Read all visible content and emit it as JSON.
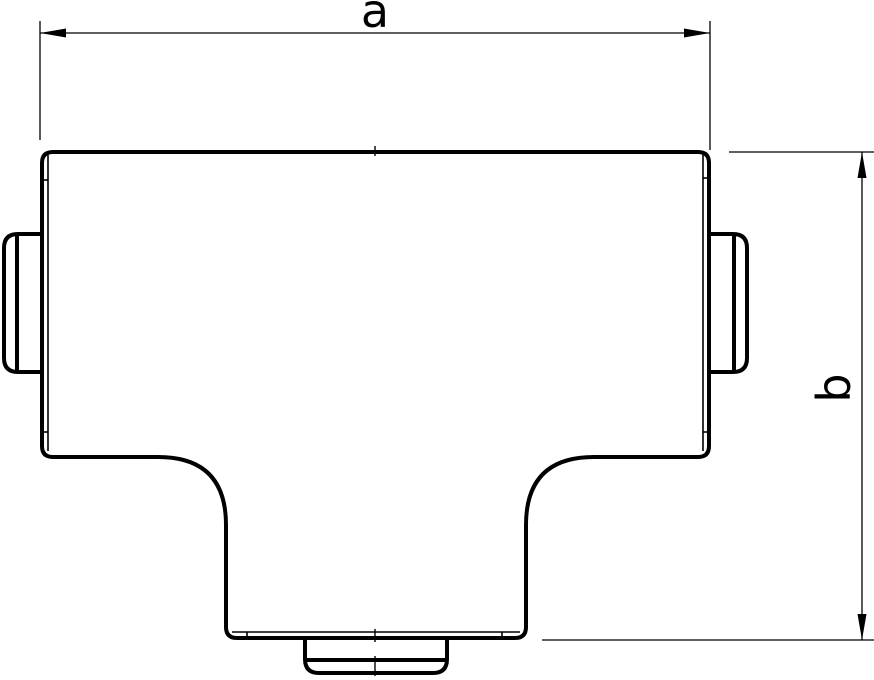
{
  "figure": {
    "kind": "technical-line-drawing",
    "subject": "tee-piece-front-view",
    "background_color": "#ffffff",
    "line_color": "#000000",
    "dimensions": {
      "width_label": "a",
      "height_label": "b"
    }
  }
}
